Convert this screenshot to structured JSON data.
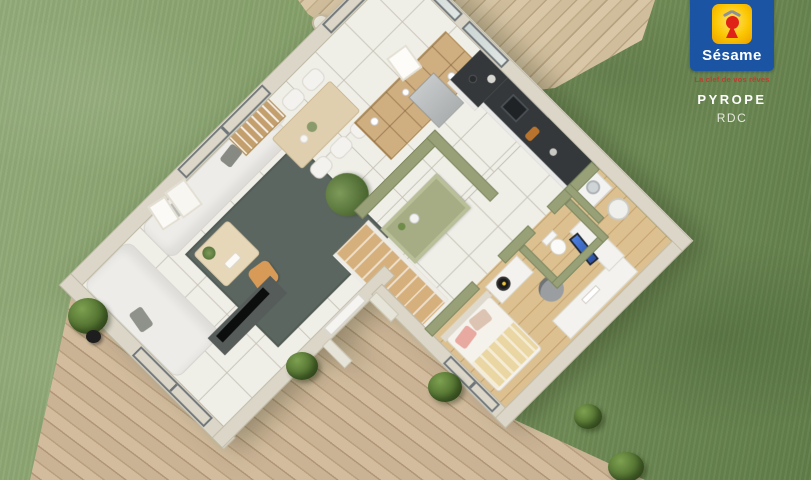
{
  "meta": {
    "canvas_width": 811,
    "canvas_height": 480,
    "view": "3D ground-floor plan render on lawn with wooden terrace"
  },
  "branding": {
    "banner": "MAISONS",
    "name": "Sésame",
    "tagline": "La clef de vos rêves",
    "program": "PYROPE",
    "level": "RDC",
    "colors": {
      "box_blue": "#1a54a3",
      "banner_yellow": "#f6c70f",
      "tile_yellow": "#fbc601",
      "keyhole_red": "#e02318",
      "tagline_red": "#c23b2e",
      "text_white": "#ffffff"
    }
  },
  "palette": {
    "grass_light": "#93ab7a",
    "grass_dark": "#617e49",
    "deck_wood": "#cab294",
    "exterior_wall": "#dbd6c8",
    "interior_green_wall": "#97a077",
    "tile_floor": "#efeee7",
    "bedroom_wood_floor": "#dcc08f",
    "kitchen_counter": "#34383a",
    "island_green": "#a6ad84",
    "rug_gray": "#5c6660",
    "sofa_white": "#edece8",
    "pouf_orange": "#d79a57",
    "stairs_wood": "#d5b07c",
    "monitor_blue": "#3a6ed0"
  },
  "rooms": [
    "garden",
    "terrace-deck",
    "upper-terrace",
    "living-room",
    "dining-area",
    "kitchen",
    "hallway",
    "entry",
    "staircase",
    "bedroom",
    "wc",
    "utility"
  ]
}
